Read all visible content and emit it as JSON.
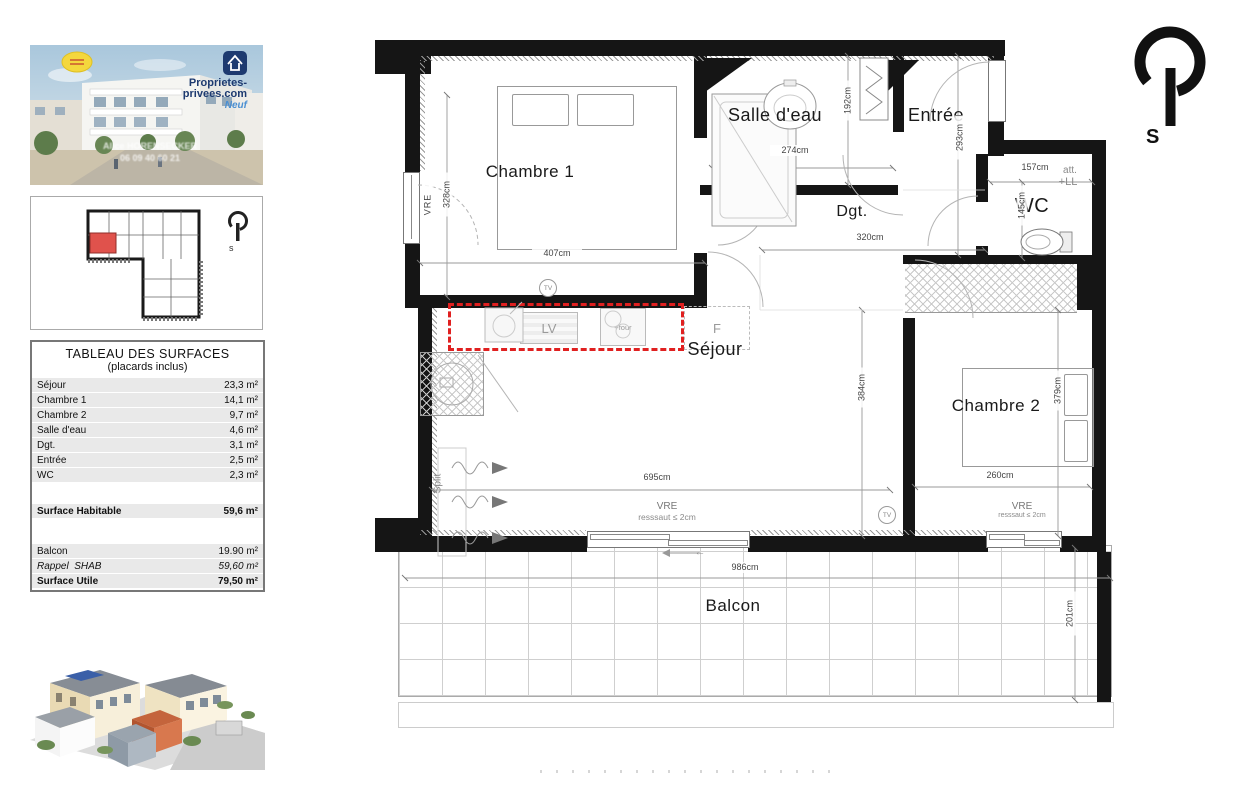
{
  "colors": {
    "kitchen_dashed": "#e02020",
    "unit_highlight": "#e0524c",
    "brand_navy": "#1d3a70",
    "brand_blue": "#4a8fd2",
    "logo_yellow": "#f4d73d",
    "wall_black": "#151515"
  },
  "photo": {
    "logo_line1": "Proprietes-",
    "logo_line2": "privees.com",
    "logo_badge": "Neuf",
    "watermark_line1": "Alice HORENSECKER",
    "watermark_line2": "06 09 40 60 21"
  },
  "miniplan": {
    "compass": "s"
  },
  "table": {
    "title": "TABLEAU DES SURFACES",
    "subtitle": "(placards inclus)",
    "rows": [
      {
        "label": "Séjour",
        "value": "23,3 m²"
      },
      {
        "label": "Chambre 1",
        "value": "14,1 m²"
      },
      {
        "label": "Chambre 2",
        "value": "9,7 m²"
      },
      {
        "label": "Salle d'eau",
        "value": "4,6 m²"
      },
      {
        "label": "Dgt.",
        "value": "3,1 m²"
      },
      {
        "label": "Entrée",
        "value": "2,5 m²"
      },
      {
        "label": "WC",
        "value": "2,3 m²"
      }
    ],
    "habitable": {
      "label": "Surface Habitable",
      "value": "59,6 m²"
    },
    "extra": [
      {
        "label": "Balcon",
        "value": "19.90 m²"
      },
      {
        "label": "Rappel  SHAB",
        "value": "59,60 m²"
      },
      {
        "label": "Surface Utile",
        "value": "79,50 m²"
      }
    ]
  },
  "plan": {
    "compass": "S",
    "rooms": {
      "chambre1": "Chambre 1",
      "salle_eau": "Salle d'eau",
      "entree": "Entrée",
      "dgt": "Dgt.",
      "wc": "WC",
      "sejour": "Séjour",
      "chambre2": "Chambre 2",
      "balcon": "Balcon"
    },
    "dims": {
      "d407": "407cm",
      "d328": "328cm",
      "d274": "274cm",
      "d192": "192cm",
      "d320": "320cm",
      "d293": "293cm",
      "d157": "157cm",
      "d145": "145cm",
      "d384": "384cm",
      "d695": "695cm",
      "d260": "260cm",
      "d379": "379cm",
      "d986": "986cm",
      "d201": "201cm"
    },
    "ann": {
      "vre": "VRE",
      "ressaut": "resssaut ≤ 2cm",
      "tv": "TV",
      "split": "Split",
      "att": "att.",
      "ll": "+LL",
      "lv": "LV",
      "four": "+four",
      "f": "F",
      "arrow": "←"
    }
  }
}
